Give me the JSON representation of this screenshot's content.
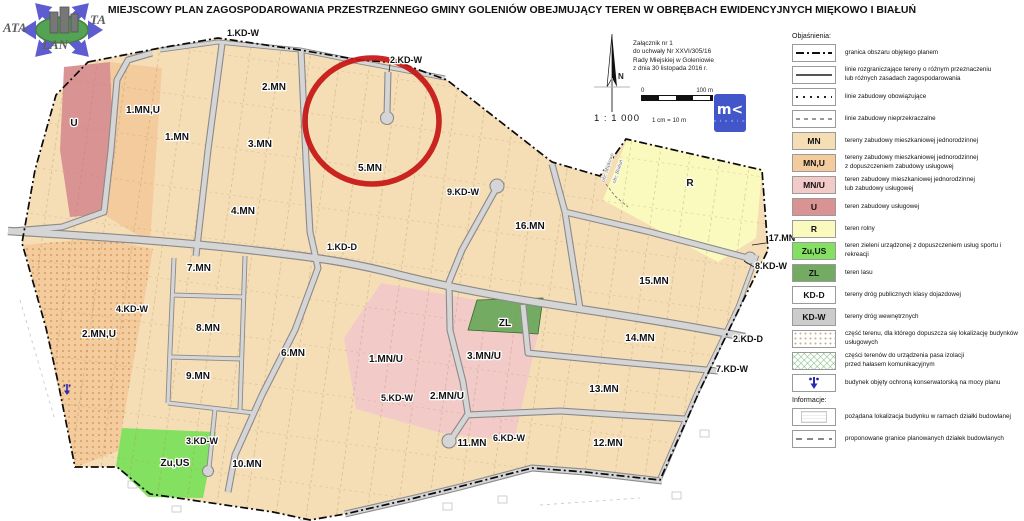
{
  "title": "MIEJSCOWY PLAN ZAGOSPODAROWANIA PRZESTRZENNEGO GMINY GOLENIÓW OBEJMUJĄCY TEREN W OBRĘBACH EWIDENCYJNYCH MIĘKOWO I BIAŁUŃ",
  "watermark": {
    "part1": "ATA",
    "part2": "TA",
    "part3": "LAN"
  },
  "annotation": {
    "lines": [
      "Załącznik nr 1",
      "do uchwały Nr XXVI/305/16",
      "Rady Miejskiej w Goleniowie",
      "z dnia 30 listopada 2016 r."
    ]
  },
  "compass": {
    "north": "N"
  },
  "scale": {
    "ratio": "1 : 1 000",
    "bar_start": "0",
    "bar_end": "100 m",
    "equiv": "1 cm = 10 m"
  },
  "logo": {
    "glyph": "m<",
    "sub": "s t u d i o"
  },
  "colors": {
    "mn": "#f5deb5",
    "mnu": "#f3cb9c",
    "mnu2": "#f2cbc8",
    "u": "#da9393",
    "r": "#fafabe",
    "zuus": "#84e060",
    "zl": "#74ab62",
    "kdd": "#ffffff",
    "kdw": "#cccccc",
    "circle": "#c51414"
  },
  "map": {
    "labels": [
      {
        "text": "1.KD-W",
        "x": 243,
        "y": 36,
        "small": true
      },
      {
        "text": "2.KD-W",
        "x": 406,
        "y": 63,
        "small": true
      },
      {
        "text": "2.MN",
        "x": 274,
        "y": 90
      },
      {
        "text": "1.MN,U",
        "x": 143,
        "y": 113
      },
      {
        "text": "U",
        "x": 74,
        "y": 126
      },
      {
        "text": "1.MN",
        "x": 177,
        "y": 140
      },
      {
        "text": "3.MN",
        "x": 260,
        "y": 147
      },
      {
        "text": "5.MN",
        "x": 370,
        "y": 171
      },
      {
        "text": "9.KD-W",
        "x": 463,
        "y": 195,
        "small": true
      },
      {
        "text": "4.MN",
        "x": 243,
        "y": 214
      },
      {
        "text": "16.MN",
        "x": 530,
        "y": 229
      },
      {
        "text": "R",
        "x": 690,
        "y": 186
      },
      {
        "text": "17.MN",
        "x": 782,
        "y": 241,
        "small": true
      },
      {
        "text": "8.KD-W",
        "x": 771,
        "y": 269,
        "small": true
      },
      {
        "text": "1.KD-D",
        "x": 342,
        "y": 250,
        "small": true
      },
      {
        "text": "7.MN",
        "x": 199,
        "y": 271
      },
      {
        "text": "15.MN",
        "x": 654,
        "y": 284
      },
      {
        "text": "4.KD-W",
        "x": 132,
        "y": 312,
        "small": true
      },
      {
        "text": "8.MN",
        "x": 208,
        "y": 331
      },
      {
        "text": "2.MN,U",
        "x": 99,
        "y": 337
      },
      {
        "text": "ZL",
        "x": 505,
        "y": 326
      },
      {
        "text": "14.MN",
        "x": 640,
        "y": 341
      },
      {
        "text": "2.KD-D",
        "x": 748,
        "y": 342,
        "small": true
      },
      {
        "text": "6.MN",
        "x": 293,
        "y": 356
      },
      {
        "text": "1.MN/U",
        "x": 386,
        "y": 362
      },
      {
        "text": "3.MN/U",
        "x": 484,
        "y": 359
      },
      {
        "text": "7.KD-W",
        "x": 732,
        "y": 372,
        "small": true
      },
      {
        "text": "9.MN",
        "x": 198,
        "y": 379
      },
      {
        "text": "13.MN",
        "x": 604,
        "y": 392
      },
      {
        "text": "2.MN/U",
        "x": 447,
        "y": 399
      },
      {
        "text": "5.KD-W",
        "x": 397,
        "y": 401,
        "small": true
      },
      {
        "text": "3.KD-W",
        "x": 202,
        "y": 444,
        "small": true
      },
      {
        "text": "11.MN",
        "x": 472,
        "y": 446
      },
      {
        "text": "6.KD-W",
        "x": 509,
        "y": 441,
        "small": true
      },
      {
        "text": "12.MN",
        "x": 608,
        "y": 446
      },
      {
        "text": "Zu,US",
        "x": 175,
        "y": 466
      },
      {
        "text": "10.MN",
        "x": 247,
        "y": 467
      }
    ],
    "rotated_labels": [
      {
        "text": "obr. Miękowo",
        "x": 609,
        "y": 168,
        "rot": -72
      },
      {
        "text": "obr. Białuń",
        "x": 619,
        "y": 172,
        "rot": -72
      }
    ]
  },
  "legend": {
    "header": "Objaśnienia:",
    "info_header": "Informacje:",
    "items": [
      {
        "symbol": "boundary",
        "label": "granica obszaru objętego planem"
      },
      {
        "symbol": "sepline",
        "label": "linie rozgraniczające tereny o różnym przeznaczeniu\nlub różnych zasadach zagospodarowania"
      },
      {
        "symbol": "oblig",
        "label": "linie zabudowy obowiązujące"
      },
      {
        "symbol": "nieprz",
        "label": "linie zabudowy nieprzekraczalne"
      },
      {
        "symbol": "zone",
        "code": "MN",
        "color": "mn",
        "label": "tereny zabudowy mieszkaniowej jednorodzinnej"
      },
      {
        "symbol": "zone",
        "code": "MN,U",
        "color": "mnu",
        "label": "tereny zabudowy mieszkaniowej jednorodzinnej\nz dopuszczeniem zabudowy usługowej"
      },
      {
        "symbol": "zone",
        "code": "MN/U",
        "color": "mnu2",
        "label": "teren zabudowy mieszkaniowej jednorodzinnej\nlub zabudowy usługowej"
      },
      {
        "symbol": "zone",
        "code": "U",
        "color": "u",
        "label": "teren zabudowy usługowej"
      },
      {
        "symbol": "zone",
        "code": "R",
        "color": "r",
        "label": "teren rolny"
      },
      {
        "symbol": "zone",
        "code": "Zu,US",
        "color": "zuus",
        "label": "teren zieleni urządzonej z dopuszczeniem usług sportu i rekreacji"
      },
      {
        "symbol": "zone",
        "code": "ZL",
        "color": "zl",
        "label": "teren lasu"
      },
      {
        "symbol": "zone",
        "code": "KD-D",
        "color": "kdd",
        "label": "tereny dróg publicznych klasy dojazdowej"
      },
      {
        "symbol": "zone",
        "code": "KD-W",
        "color": "kdw",
        "label": "tereny dróg wewnętrznych"
      },
      {
        "symbol": "dots",
        "label": "część terenu, dla którego dopuszcza się lokalizację budynków usługowych"
      },
      {
        "symbol": "hatch",
        "label": "części terenów do urządzenia pasa izolacji\nprzed hałasem komunikacyjnym"
      },
      {
        "symbol": "monument",
        "label": "budynek objęty ochroną konserwatorską na mocy planu"
      }
    ],
    "info_items": [
      {
        "symbol": "desired",
        "label": "pożądana lokalizacja budynku w ramach działki budowlanej"
      },
      {
        "symbol": "proposed",
        "label": "proponowane granice planowanych działek budowlanych"
      }
    ]
  }
}
